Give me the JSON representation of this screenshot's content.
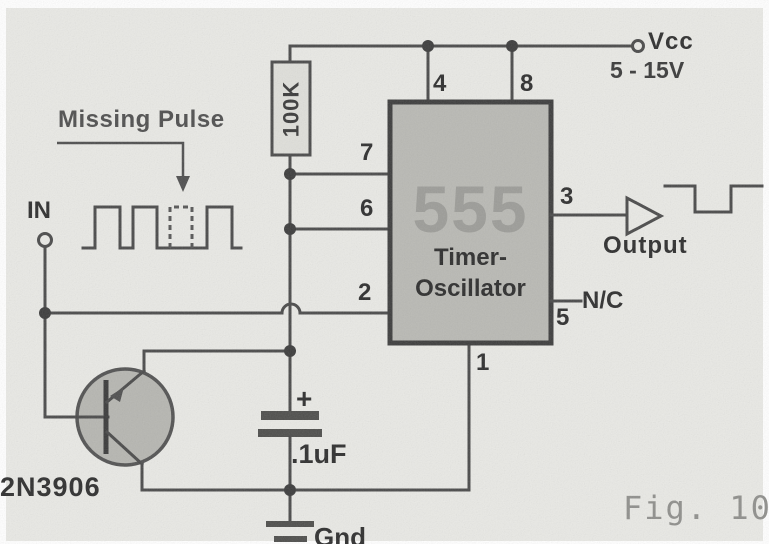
{
  "figure": {
    "caption": "Fig. 10a"
  },
  "colors": {
    "paper": "#e9e9e5",
    "ink": "#4a4a4a",
    "chip_fill": "#b9b9b4",
    "chip_border": "#3d3d3d",
    "watermark": "#9c9c98",
    "caption": "#8f8f8c"
  },
  "power": {
    "vcc_label": "Vcc",
    "vcc_range": "5 - 15V"
  },
  "input": {
    "terminal_label": "IN",
    "annotation": "Missing Pulse"
  },
  "output": {
    "label": "Output"
  },
  "chip": {
    "watermark": "555",
    "name_line1": "Timer-",
    "name_line2": "Oscillator",
    "nc_label": "N/C",
    "pins": {
      "p1": "1",
      "p2": "2",
      "p3": "3",
      "p4": "4",
      "p5": "5",
      "p6": "6",
      "p7": "7",
      "p8": "8"
    }
  },
  "components": {
    "resistor_value": "100K",
    "capacitor_value": ".1uF",
    "capacitor_polarity": "+",
    "transistor_part": "2N3906",
    "ground_label": "Gnd"
  }
}
